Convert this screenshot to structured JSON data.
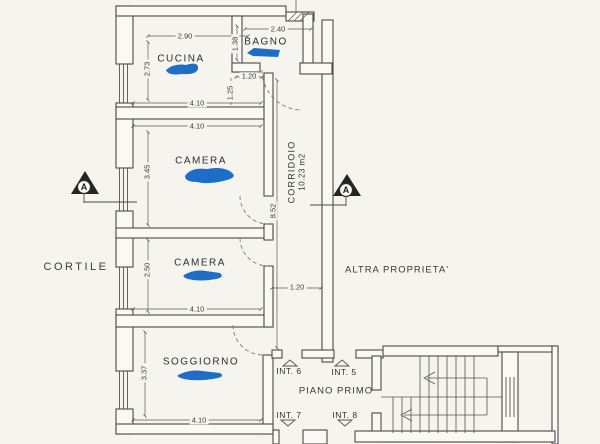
{
  "colors": {
    "paper": "#f5f4ef",
    "line_ink": "#4a4a49",
    "scribble_blue": "#1e6ec8"
  },
  "rooms": {
    "cucina": {
      "label": "CUCINA"
    },
    "bagno": {
      "label": "BAGNO"
    },
    "camera1": {
      "label": "CAMERA"
    },
    "camera2": {
      "label": "CAMERA"
    },
    "soggiorno": {
      "label": "SOGGIORNO"
    },
    "corridoio": {
      "label": "CORRIDOIO",
      "area": "10.23 m2"
    }
  },
  "annotations": {
    "cortile": "CORTILE",
    "altra_proprieta": "ALTRA PROPRIETA'",
    "piano_primo": "PIANO PRIMO",
    "int5": "INT. 5",
    "int6": "INT. 6",
    "int7": "INT. 7",
    "int8": "INT. 8",
    "section_marker": "A"
  },
  "dimensions": {
    "cucina_width": "2.90",
    "cucina_height": "2.73",
    "bagno_width": "2.40",
    "bagno_depth": "1.38",
    "bagno_door": "1.20",
    "corridor_neck": "1.25",
    "cucina_bottom": "4.10",
    "camera1_top": "4.10",
    "camera1_height": "3.45",
    "corridor_length": "8.52",
    "camera2_height": "2.50",
    "camera2_width": "4.10",
    "corridor_width": "1.20",
    "soggiorno_height": "3.37",
    "soggiorno_width": "4.10"
  }
}
